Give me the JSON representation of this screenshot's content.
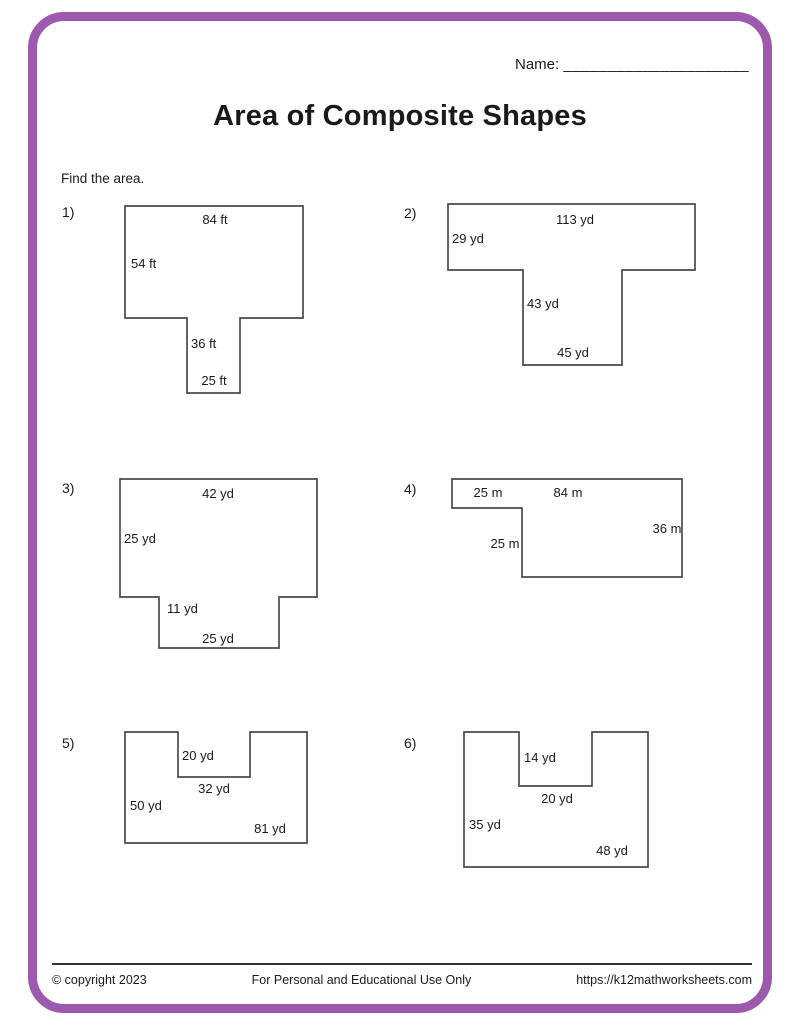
{
  "style": {
    "border_color": "#9c59ae",
    "shape_stroke": "#4a4a4a",
    "text_color": "#1a1a1a"
  },
  "header": {
    "name_label": "Name:",
    "name_line": "_____________________",
    "title": "Area of Composite Shapes",
    "instruction": "Find the area."
  },
  "problems": [
    {
      "number": "1)",
      "unit": "ft",
      "num_pos": {
        "left": 62,
        "top": 204
      },
      "svg": {
        "left": 120,
        "top": 200,
        "width": 205,
        "height": 205
      },
      "points": "5,6 183,6 183,118 120,118 120,193 67,193 67,118 5,118",
      "labels": [
        {
          "text": "84 ft",
          "x": 95,
          "y": 24,
          "anchor": "middle"
        },
        {
          "text": "54 ft",
          "x": 11,
          "y": 68,
          "anchor": "start"
        },
        {
          "text": "36 ft",
          "x": 71,
          "y": 148,
          "anchor": "start"
        },
        {
          "text": "25 ft",
          "x": 94,
          "y": 185,
          "anchor": "middle"
        }
      ]
    },
    {
      "number": "2)",
      "unit": "yd",
      "num_pos": {
        "left": 404,
        "top": 205
      },
      "svg": {
        "left": 400,
        "top": 200,
        "width": 310,
        "height": 180
      },
      "points": "48,4 295,4 295,70 222,70 222,165 123,165 123,70 48,70",
      "labels": [
        {
          "text": "113  yd",
          "x": 175,
          "y": 24,
          "anchor": "middle"
        },
        {
          "text": "29 yd",
          "x": 52,
          "y": 43,
          "anchor": "start"
        },
        {
          "text": "43 yd",
          "x": 127,
          "y": 108,
          "anchor": "start"
        },
        {
          "text": "45 yd",
          "x": 173,
          "y": 157,
          "anchor": "middle"
        }
      ]
    },
    {
      "number": "3)",
      "unit": "yd",
      "num_pos": {
        "left": 62,
        "top": 480
      },
      "svg": {
        "left": 115,
        "top": 470,
        "width": 215,
        "height": 190
      },
      "points": "5,9 202,9 202,127 164,127 164,178 44,178 44,127 5,127",
      "labels": [
        {
          "text": "42 yd",
          "x": 103,
          "y": 28,
          "anchor": "middle"
        },
        {
          "text": "25 yd",
          "x": 9,
          "y": 73,
          "anchor": "start"
        },
        {
          "text": "11 yd",
          "x": 52,
          "y": 143,
          "anchor": "start"
        },
        {
          "text": "25 yd",
          "x": 103,
          "y": 173,
          "anchor": "middle"
        }
      ]
    },
    {
      "number": "4)",
      "unit": "m",
      "num_pos": {
        "left": 404,
        "top": 481
      },
      "svg": {
        "left": 400,
        "top": 470,
        "width": 300,
        "height": 120
      },
      "points": "52,9 282,9 282,107 122,107 122,38 52,38",
      "labels": [
        {
          "text": "25 m",
          "x": 88,
          "y": 27,
          "anchor": "middle"
        },
        {
          "text": "84 m",
          "x": 168,
          "y": 27,
          "anchor": "middle"
        },
        {
          "text": "36 m",
          "x": 267,
          "y": 63,
          "anchor": "middle"
        },
        {
          "text": "25 m",
          "x": 105,
          "y": 78,
          "anchor": "middle"
        }
      ]
    },
    {
      "number": "5)",
      "unit": "yd",
      "num_pos": {
        "left": 62,
        "top": 735
      },
      "svg": {
        "left": 115,
        "top": 725,
        "width": 210,
        "height": 130
      },
      "points": "10,7 63,7 63,52 135,52 135,7 192,7 192,118 10,118",
      "labels": [
        {
          "text": "20 yd",
          "x": 67,
          "y": 35,
          "anchor": "start"
        },
        {
          "text": "32 yd",
          "x": 99,
          "y": 68,
          "anchor": "middle"
        },
        {
          "text": "50 yd",
          "x": 15,
          "y": 85,
          "anchor": "start"
        },
        {
          "text": "81 yd",
          "x": 155,
          "y": 108,
          "anchor": "middle"
        }
      ]
    },
    {
      "number": "6)",
      "unit": "yd",
      "num_pos": {
        "left": 404,
        "top": 735
      },
      "svg": {
        "left": 455,
        "top": 725,
        "width": 210,
        "height": 150
      },
      "points": "9,7 64,7 64,61 137,61 137,7 193,7 193,142 9,142",
      "labels": [
        {
          "text": "14 yd",
          "x": 69,
          "y": 37,
          "anchor": "start"
        },
        {
          "text": "20 yd",
          "x": 102,
          "y": 78,
          "anchor": "middle"
        },
        {
          "text": "35 yd",
          "x": 14,
          "y": 104,
          "anchor": "start"
        },
        {
          "text": "48 yd",
          "x": 157,
          "y": 130,
          "anchor": "middle"
        }
      ]
    }
  ],
  "footer": {
    "copyright": "© copyright 2023",
    "usage": "For Personal and Educational Use Only",
    "url": "https://k12mathworksheets.com"
  }
}
